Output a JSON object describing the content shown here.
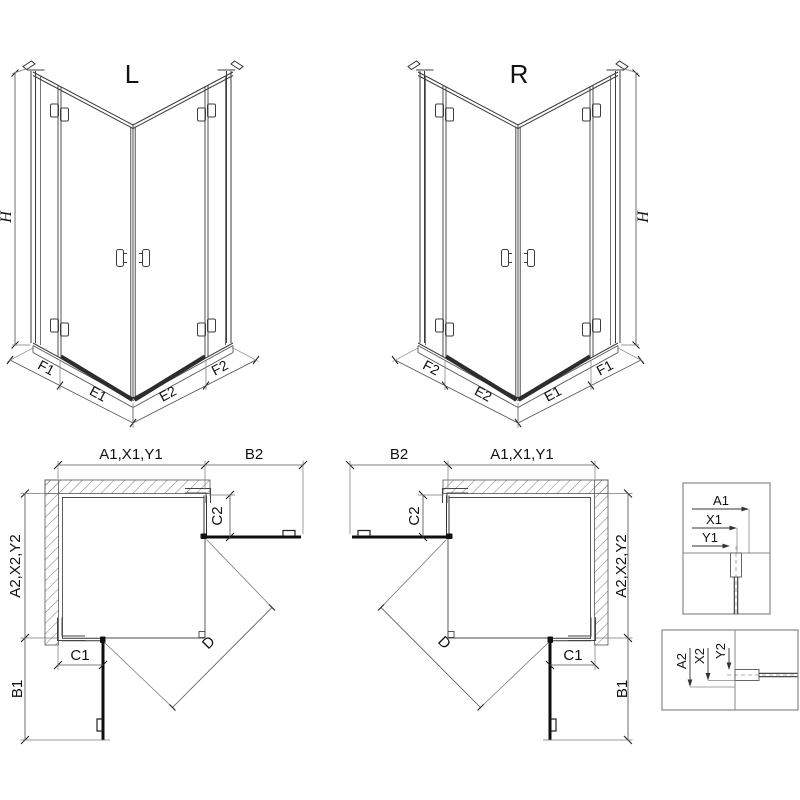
{
  "iso_views": {
    "left": {
      "title": "L",
      "height_label": "H",
      "segments": {
        "f1": "F1",
        "e1": "E1",
        "e2": "E2",
        "f2": "F2"
      }
    },
    "right": {
      "title": "R",
      "height_label": "H",
      "segments": {
        "f1": "F1",
        "e1": "E1",
        "e2": "E2",
        "f2": "F2"
      }
    }
  },
  "plan_views": {
    "left": {
      "width_total": "A1,X1,Y1",
      "door_width": "B2",
      "fixed_inset_top": "C2",
      "depth_total": "A2,X2,Y2",
      "door_depth": "B1",
      "fixed_inset_side": "C1",
      "diagonal_opening": "D"
    },
    "right": {
      "width_total": "A1,X1,Y1",
      "door_width": "B2",
      "fixed_inset_top": "C2",
      "depth_total": "A2,X2,Y2",
      "door_depth": "B1",
      "fixed_inset_side": "C1",
      "diagonal_opening": "D"
    }
  },
  "details": {
    "horizontal_profile": {
      "labels": [
        "A1",
        "X1",
        "Y1"
      ]
    },
    "vertical_profile": {
      "labels": [
        "A2",
        "X2",
        "Y2"
      ]
    }
  },
  "colors": {
    "line": "#3d3d3d",
    "dim": "#555555",
    "heavy": "#0d0d0d",
    "hatch": "#6a6a6a"
  }
}
